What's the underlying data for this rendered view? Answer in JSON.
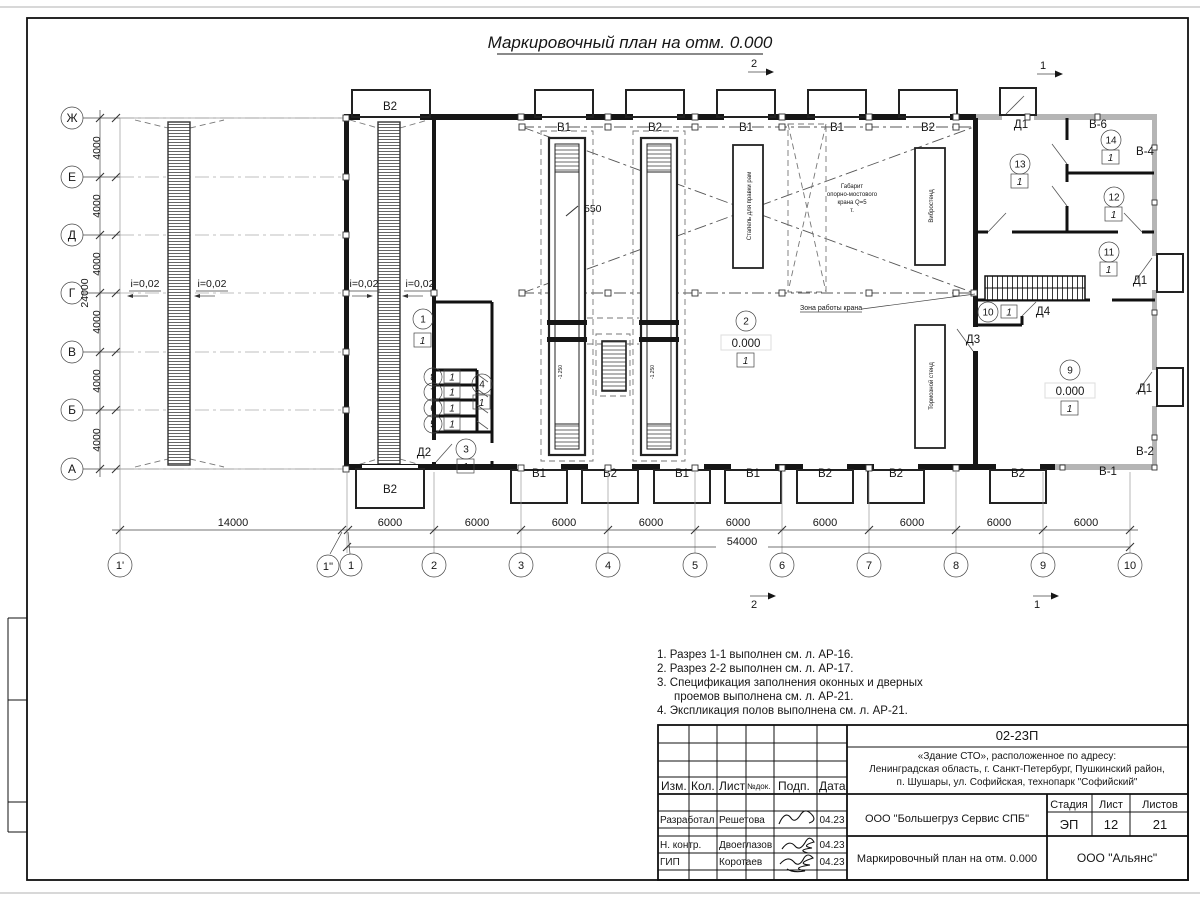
{
  "sheet": {
    "title": "Маркировочный план на отм. 0.000",
    "notes": [
      "1. Разрез 1-1 выполнен см. л. АР-16.",
      "2. Разрез 2-2 выполнен см. л. АР-17.",
      "3. Спецификация заполнения оконных и дверных",
      "проемов выполнена см. л. АР-21.",
      "4. Экспликация полов выполнена см. л. АР-21."
    ]
  },
  "axes": {
    "rows": [
      "Ж",
      "Е",
      "Д",
      "Г",
      "В",
      "Б",
      "А"
    ],
    "row_dim": "4000",
    "row_total": "24000",
    "cols": [
      "1'",
      "1''",
      "1",
      "2",
      "3",
      "4",
      "5",
      "6",
      "7",
      "8",
      "9",
      "10"
    ],
    "first_bay": "14000",
    "bay": "6000",
    "col_total": "54000"
  },
  "marks": {
    "s1": "1",
    "s2": "2"
  },
  "plan": {
    "slope": "i=0,02",
    "top_gates": [
      "В2",
      "В1",
      "В2",
      "В1",
      "В1",
      "В2"
    ],
    "bottom_gates": [
      "В2",
      "В1",
      "В2",
      "В1",
      "В1",
      "В2",
      "В2",
      "В2"
    ],
    "windows": {
      "v6": "В-6",
      "v4": "В-4",
      "v2": "В-2",
      "v1": "В-1"
    },
    "doors": {
      "d1": "Д1",
      "d2": "Д2",
      "d3": "Д3",
      "d4": "Д4"
    },
    "pit_elev": "-1.250",
    "pit_dim": "550",
    "crane_zone": "Зона работы крана",
    "crane_gabarit": [
      "Габарит",
      "опорно-мостового",
      "крана Q=5",
      "т."
    ],
    "equipment": [
      "Стапель для правки рам",
      "Вибростенд",
      "Тормозной стенд"
    ],
    "elev_zero": "0.000",
    "floor_type": "1",
    "rooms": {
      "r1": "1",
      "r2": "2",
      "r3": "3",
      "r4": "4",
      "r5": "5",
      "r6": "6",
      "r7": "7",
      "r8": "8",
      "r9": "9",
      "r10": "10",
      "r11": "11",
      "r12": "12",
      "r13": "13",
      "r14": "14"
    }
  },
  "title_block": {
    "code": "02-23П",
    "object_line1": "«Здание СТО», расположенное по адресу:",
    "object_line2": "Ленинградская область, г. Санкт-Петербург, Пушкинский район,",
    "object_line3": "п. Шушары, ул. Софийская, технопарк \"Софийский\"",
    "h_izm": "Изм.",
    "h_kol": "Кол.",
    "h_list": "Лист",
    "h_doc": "№док.",
    "h_sign": "Подп.",
    "h_date": "Дата",
    "r1_role": "Разработал",
    "r1_name": "Решетова",
    "r2_role": "Н. контр.",
    "r2_name": "Двоеглазов",
    "r3_role": "ГИП",
    "r3_name": "Коротаев",
    "date": "04.23",
    "org": "ООО \"Большегруз Сервис СПБ\"",
    "h_stage": "Стадия",
    "h_sheet": "Лист",
    "h_sheets": "Листов",
    "stage": "ЭП",
    "sheet_no": "12",
    "sheets_total": "21",
    "doc_title": "Маркировочный план на отм. 0.000",
    "company": "ООО \"Альянс\""
  }
}
